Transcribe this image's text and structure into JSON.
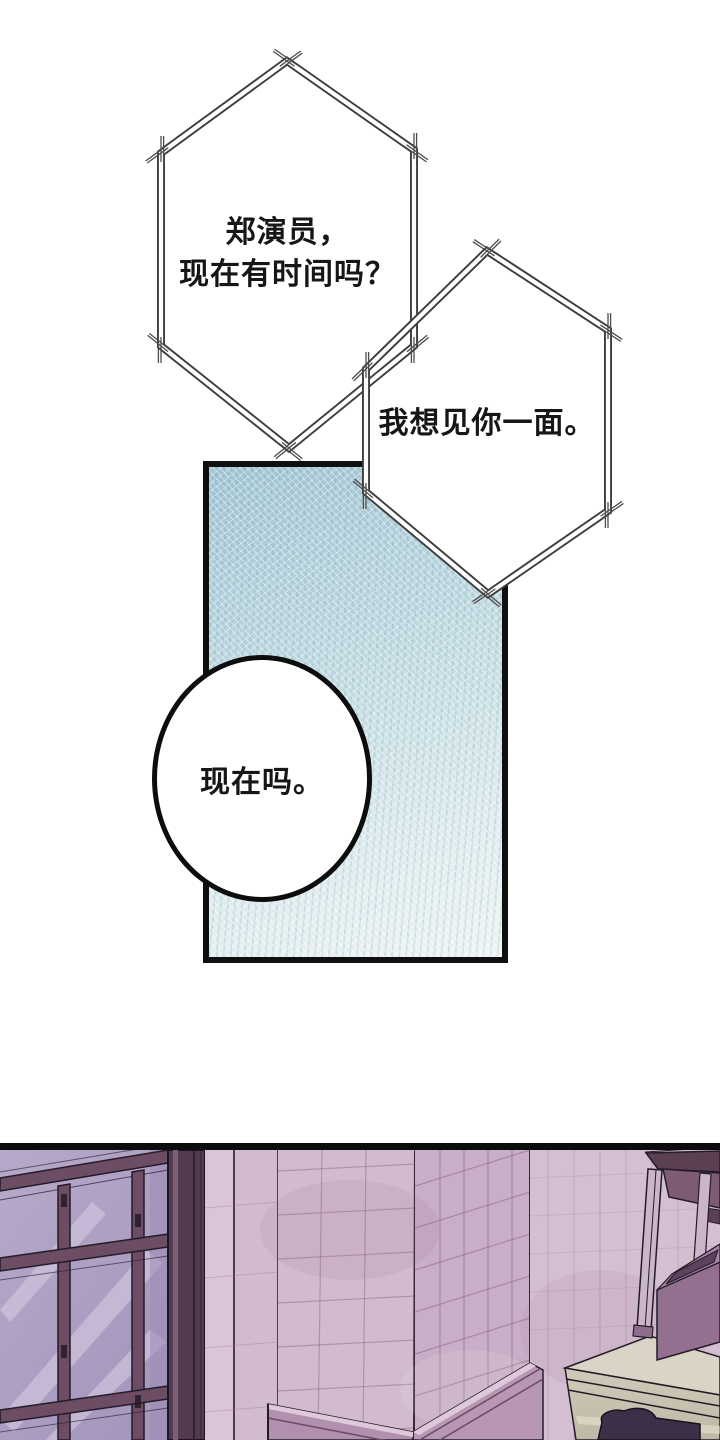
{
  "comic": {
    "phone_bubble_1": {
      "line1": "郑演员，",
      "line2": "现在有时间吗？"
    },
    "phone_bubble_2": {
      "text": "我想见你一面。"
    },
    "speech_bubble": {
      "text": "现在吗。"
    }
  },
  "colors": {
    "ink": "#3d3d3d",
    "panel_border": "#0f0f0f",
    "blue_texture_top": "#9fc3d2",
    "blue_texture_bottom": "#eef4f4",
    "wall_mauve": "#d0b8ce",
    "window_frame_plum": "#533a50",
    "window_glass": "#ab9ec2",
    "bench_stone": "#d9d4c6",
    "table_wood_dark": "#5b4054"
  }
}
